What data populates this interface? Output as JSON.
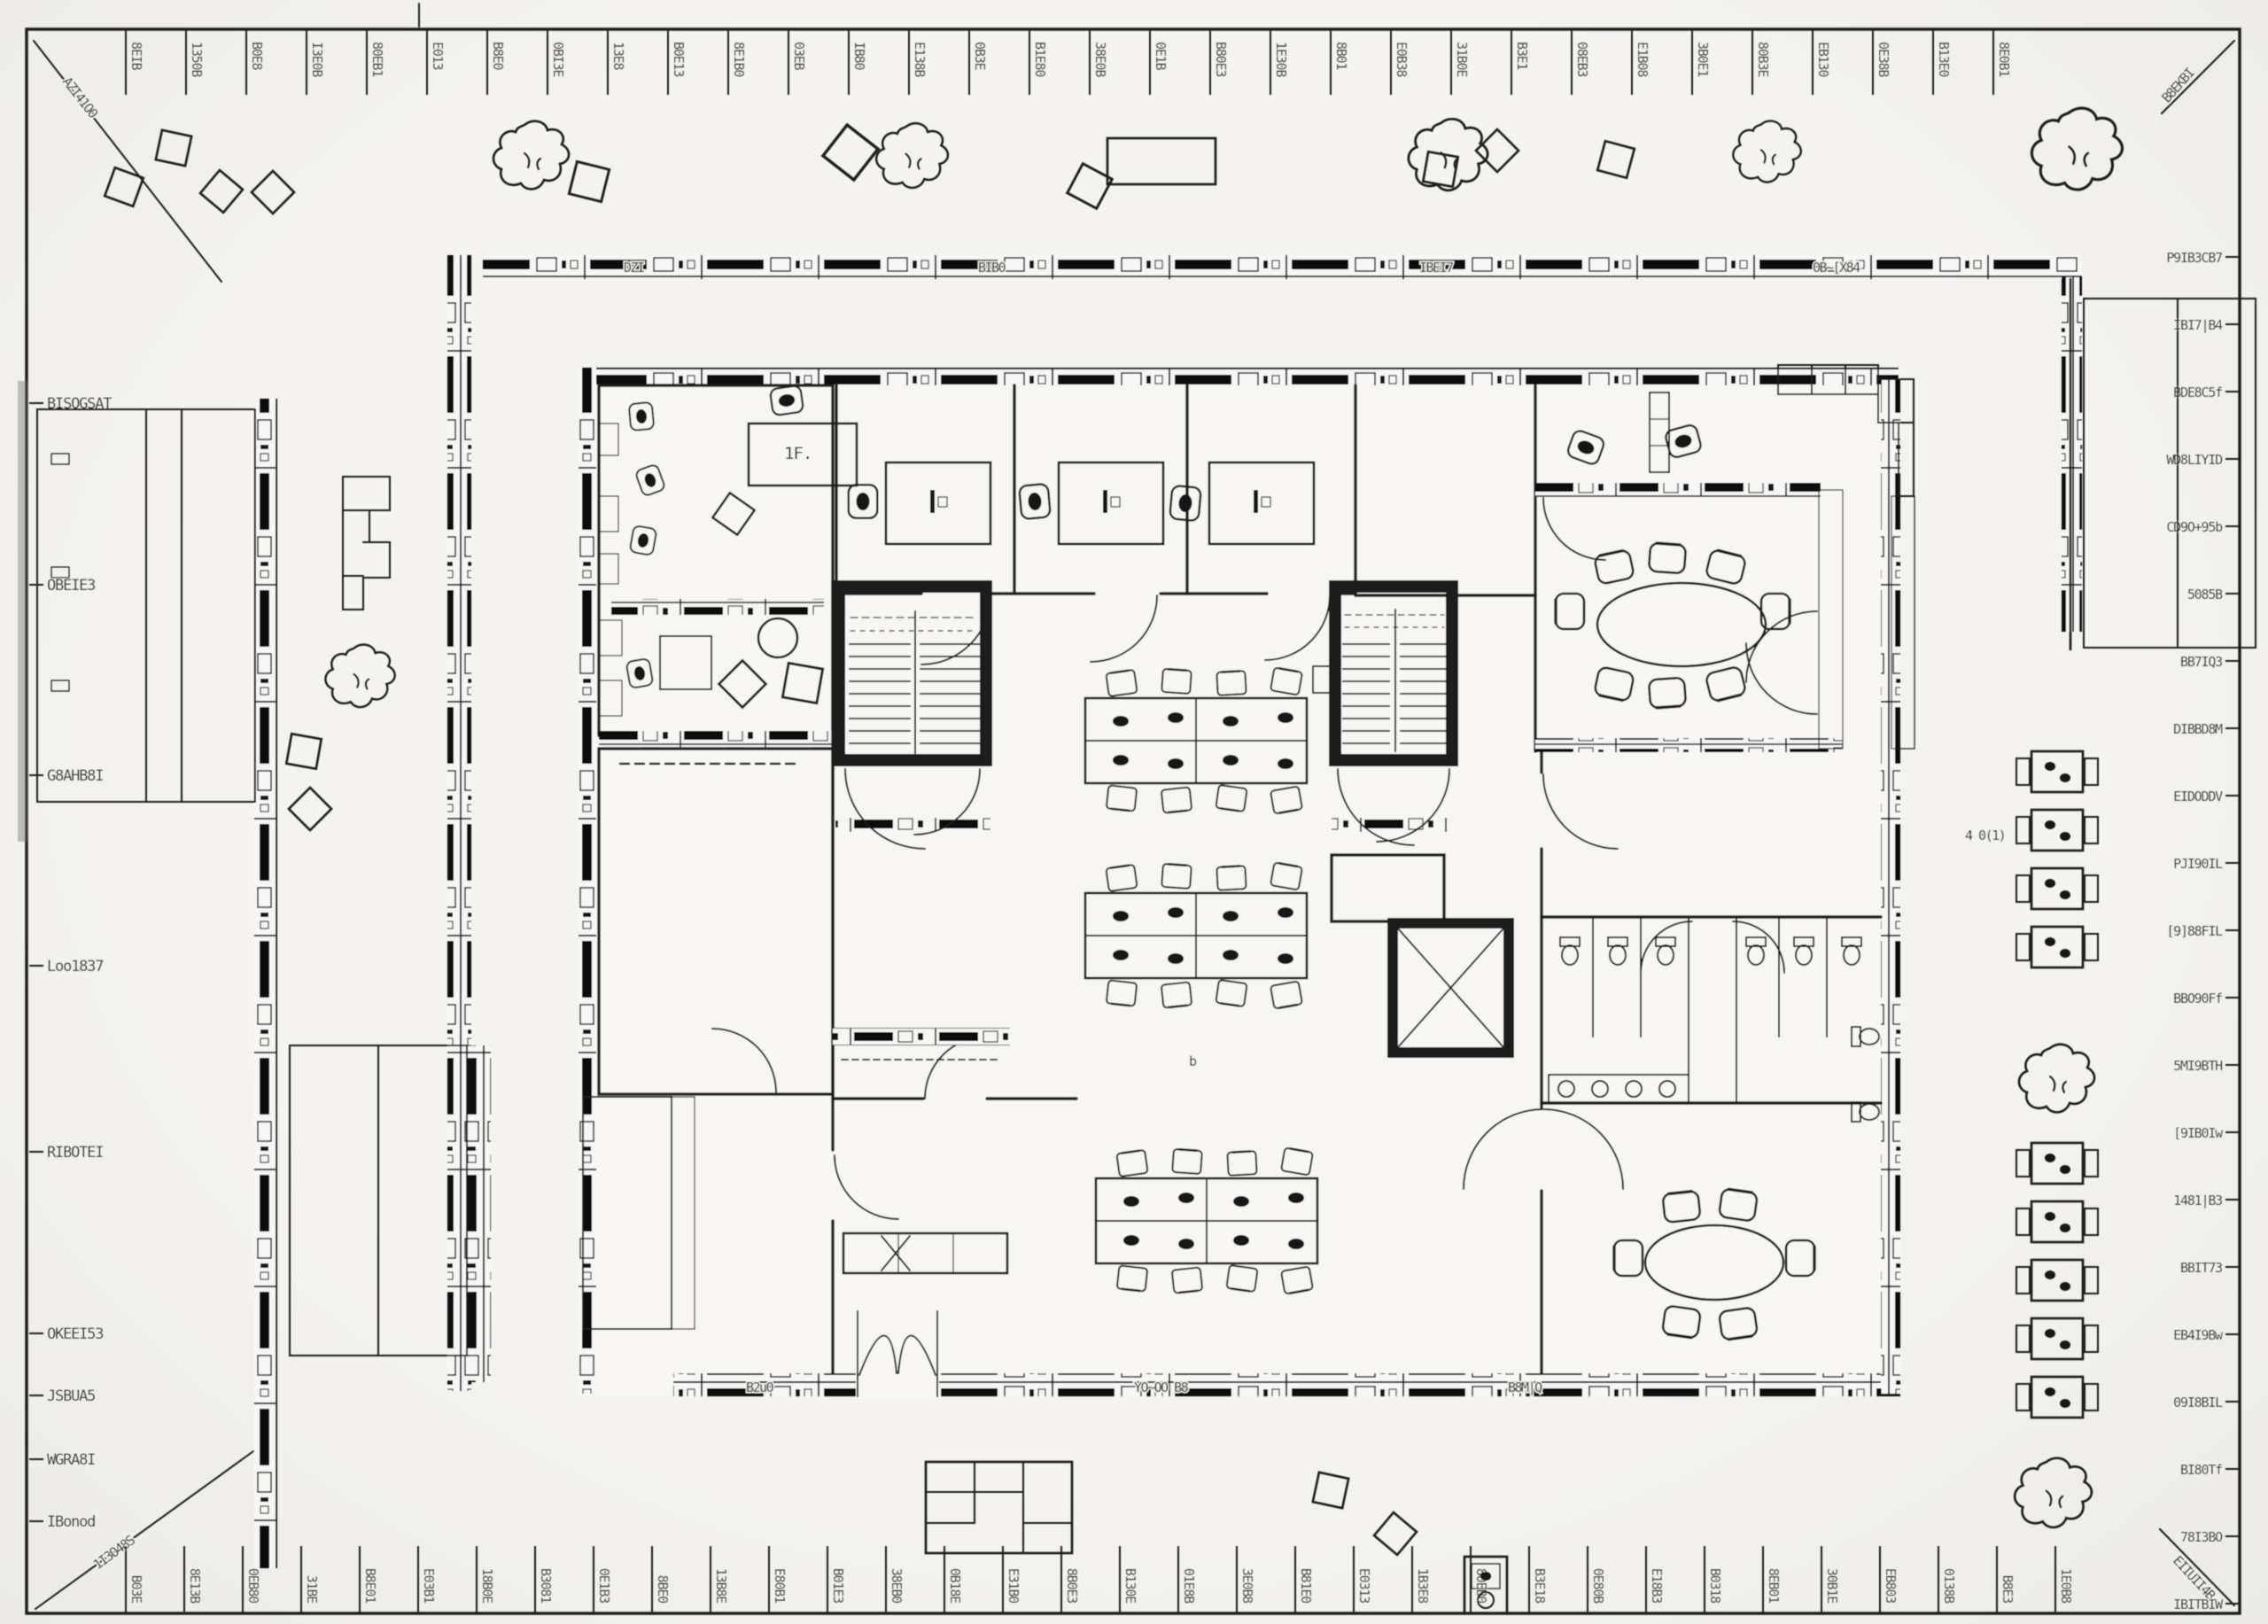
{
  "palette": {
    "paper": "#f2f1ee",
    "ink": "#1a1a1a",
    "slab": "#101010",
    "rubble": "#3a3a3a"
  },
  "dimensions": {
    "top_ticks": [
      "8EIB",
      "1350B",
      "B0E8",
      "I3E0B",
      "80EB1",
      "E013",
      "B8E0",
      "0BI3E",
      "13E8",
      "B0E13",
      "8E1B0",
      "03EB",
      "IB80",
      "E138B",
      "0B3E",
      "B1E80",
      "38E0B",
      "0E1B",
      "B80E3",
      "1E30B",
      "8B01",
      "E0B38",
      "31B0E",
      "B3E1",
      "08EB3",
      "E1B08",
      "3B0E1",
      "80B3E",
      "EB130",
      "0E38B",
      "B13E0",
      "8E0B1"
    ],
    "bottom_ticks": [
      "B03E",
      "8E13B",
      "0EB80",
      "31BE",
      "B8E01",
      "E03B1",
      "18B0E",
      "B3081",
      "0E1B3",
      "8BE0",
      "13B8E",
      "E80B1",
      "B01E3",
      "38EB0",
      "0B18E",
      "E31B0",
      "8B0E3",
      "B130E",
      "01E8B",
      "3E0B8",
      "B81E0",
      "E0313",
      "1B3E8",
      "80EB0",
      "B3E18",
      "0E80B",
      "E18B3",
      "B0318",
      "8EB01",
      "30B1E",
      "EB803",
      "0138B",
      "B8E3",
      "1E0B8"
    ],
    "left_labels": [
      "BISOGSAT",
      "OBEIE3",
      "G8AHB8I",
      "Loo1837",
      "RIBOTEI",
      "OKEEI53",
      "JSBUA5",
      "WGRA8I",
      "IBonod"
    ],
    "right_labels": [
      "P9IB3CB7",
      "IBI7|B4",
      "BDE8C5f",
      "WD8LIYID",
      "CD9O+95b",
      "5085B",
      "BB7IQ3",
      "DIBBD8M",
      "EIDODDV",
      "PJI90IL",
      "[9]88FIL",
      "BBO90Ff",
      "5MI9BTH",
      "[9IB0Iw",
      "1481|B3",
      "BBIT73",
      "EB4I9Bw",
      "09I8BIL",
      "BI80Tf",
      "78I3BO",
      "IBITBIW"
    ],
    "corner_notes": {
      "top_left": "AZI41O0",
      "top_right": "B8EKBI",
      "bottom_left": "1I3O48S",
      "bottom_right": "EIIUII4B"
    }
  },
  "labels": {
    "reception_desk": "1F.",
    "right_bench_note": "4 0(1)",
    "center_mark": "b",
    "north_wall_texts": [
      "DZI",
      "BIB0",
      "IBEI7",
      "0B~[X84"
    ],
    "south_wall_texts": [
      "B2u0",
      "YO~OO  B8",
      "B8M|Q"
    ]
  }
}
